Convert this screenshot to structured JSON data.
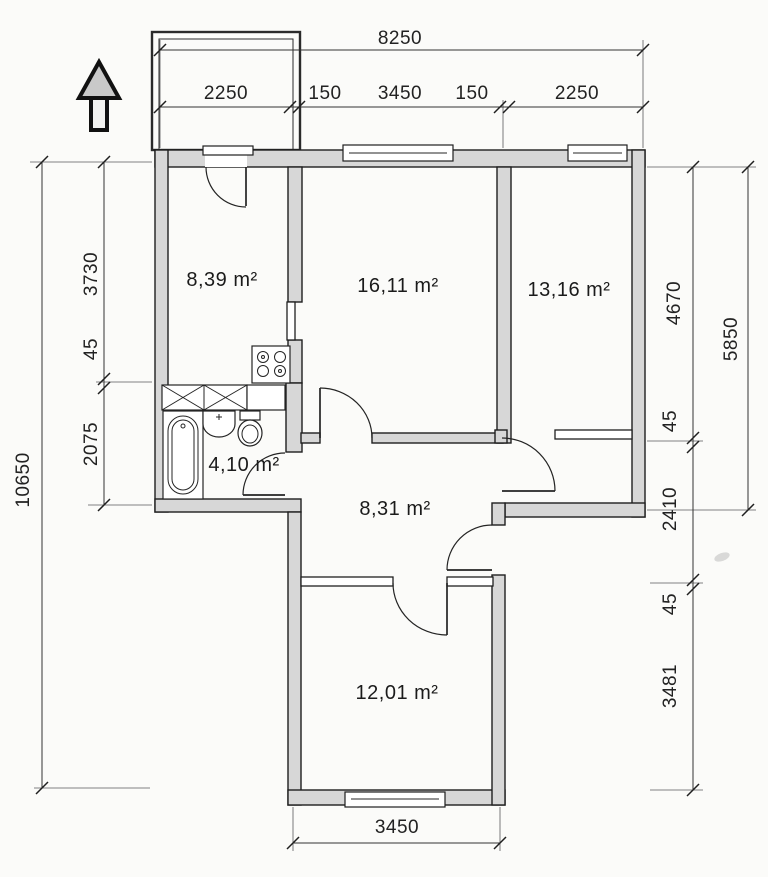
{
  "plan": {
    "type": "apartment-floor-plan",
    "orientation_marker": "north-arrow-up",
    "colors": {
      "wall_fill": "#d7d7d7",
      "line": "#1f1f1f",
      "paper": "#fbfbf9"
    },
    "rooms": {
      "kitchen": {
        "area": "8,39 m²"
      },
      "living": {
        "area": "16,11 m²"
      },
      "bedroom_right": {
        "area": "13,16 m²"
      },
      "bathroom": {
        "area": "4,10 m²"
      },
      "hall": {
        "area": "8,31 m²"
      },
      "bedroom_bottom": {
        "area": "12,01 m²"
      }
    },
    "dims": {
      "top_total": "8250",
      "top_segs": [
        "2250",
        "150",
        "3450",
        "150",
        "2250"
      ],
      "left_total": "10650",
      "left_segs": [
        "3730",
        "45",
        "2075"
      ],
      "right_segs": [
        "4670",
        "45",
        "2410",
        "45",
        "3481"
      ],
      "right_outer": "5850",
      "bottom_width": "3450"
    }
  }
}
